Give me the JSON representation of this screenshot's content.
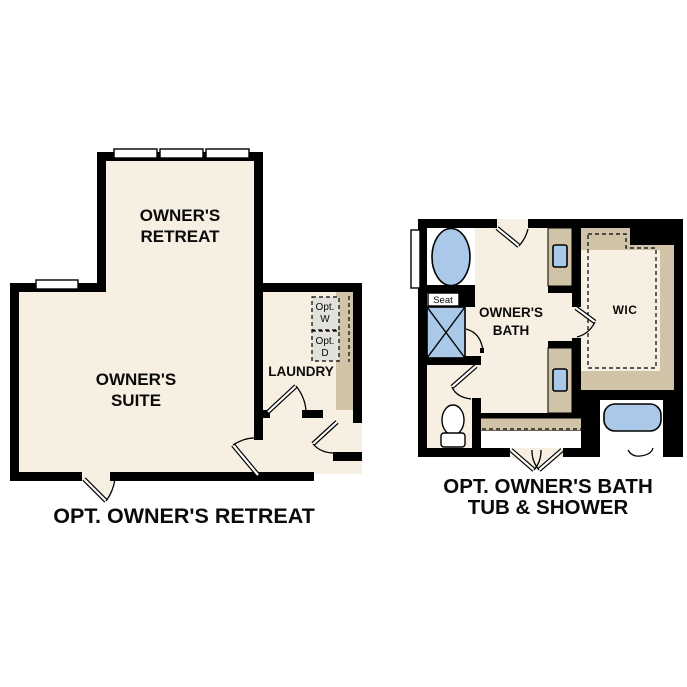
{
  "page": {
    "background": "#ffffff"
  },
  "colors": {
    "floor_cream": "#f7efe2",
    "wall_black": "#000000",
    "cabinet_tan": "#d0c3a8",
    "fixture_blue": "#aac9e9",
    "appliance_gray": "#e3e1db",
    "fixture_white": "#ffffff"
  },
  "retreat_plan": {
    "caption": "OPT. OWNER'S RETREAT",
    "rooms": {
      "owners_retreat": {
        "line1": "OWNER'S",
        "line2": "RETREAT"
      },
      "owners_suite": {
        "line1": "OWNER'S",
        "line2": "SUITE"
      },
      "laundry": "LAUNDRY"
    },
    "appliances": {
      "washer": {
        "line1": "Opt.",
        "line2": "W"
      },
      "dryer": {
        "line1": "Opt.",
        "line2": "D"
      }
    }
  },
  "bath_plan": {
    "caption_line1": "OPT. OWNER'S BATH",
    "caption_line2": "TUB & SHOWER",
    "rooms": {
      "owners_bath": {
        "line1": "OWNER'S",
        "line2": "BATH"
      },
      "wic": "WIC",
      "seat": "Seat"
    }
  }
}
